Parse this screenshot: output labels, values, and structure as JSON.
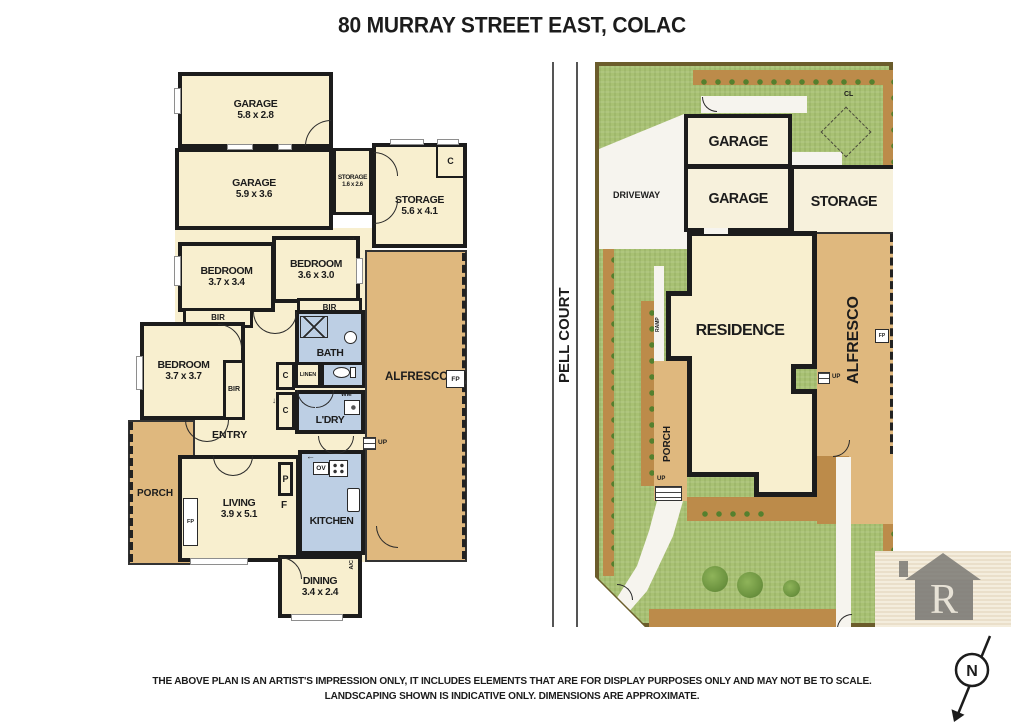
{
  "title": "80 MURRAY STREET EAST, COLAC",
  "floorplan": {
    "garage_top": {
      "label": "GARAGE",
      "dims": "5.8 x 2.8"
    },
    "garage_lower": {
      "label": "GARAGE",
      "dims": "5.9 x 3.6"
    },
    "storage_small": {
      "label": "STORAGE",
      "dims": "1.6 x 2.6"
    },
    "storage_large": {
      "label": "STORAGE",
      "dims": "5.6 x 4.1"
    },
    "bedroom_one": {
      "label": "BEDROOM",
      "dims": "3.7 x 3.4"
    },
    "bedroom_two": {
      "label": "BEDROOM",
      "dims": "3.6 x 3.0"
    },
    "bedroom_three": {
      "label": "BEDROOM",
      "dims": "3.7 x 3.7"
    },
    "living": {
      "label": "LIVING",
      "dims": "3.9 x 5.1"
    },
    "dining": {
      "label": "DINING",
      "dims": "3.4 x 2.4"
    },
    "bath": "BATH",
    "linen": "LINEN",
    "laundry": "L'DRY",
    "kitchen": "KITCHEN",
    "entry": "ENTRY",
    "porch": "PORCH",
    "alfresco": "ALFRESCO",
    "bir": "BIR",
    "cupboard": "C",
    "pantry": "P",
    "fridge": "F",
    "oven": "OV",
    "washing_machine": "WM",
    "fireplace": "FP",
    "up": "UP",
    "aircon": "A/C",
    "symbols": {
      "right": "→",
      "left": "←",
      "down": "↓"
    }
  },
  "siteplan": {
    "street": "PELL COURT",
    "driveway": "DRIVEWAY",
    "garage": "GARAGE",
    "storage": "STORAGE",
    "residence": "RESIDENCE",
    "alfresco": "ALFRESCO",
    "porch": "PORCH",
    "clothesline": "CL",
    "ramp": "RAMP",
    "up": "UP",
    "fireplace": "FP"
  },
  "compass": {
    "north": "N"
  },
  "watermark": {
    "initial": "R"
  },
  "disclaimer": {
    "line1": "THE ABOVE PLAN IS AN ARTIST'S IMPRESSION ONLY, IT INCLUDES ELEMENTS THAT ARE FOR DISPLAY PURPOSES ONLY AND MAY NOT BE TO SCALE.",
    "line2": "LANDSCAPING SHOWN IS INDICATIVE ONLY. DIMENSIONS ARE APPROXIMATE."
  },
  "colors": {
    "room_fill": "#f8efcf",
    "deck_fill": "#dfb87e",
    "wet_fill": "#bdcfe4",
    "wall": "#1c1c1c",
    "lawn": "#a8c173",
    "garden": "#bc8b4a",
    "site_border": "#6b5c2b"
  }
}
